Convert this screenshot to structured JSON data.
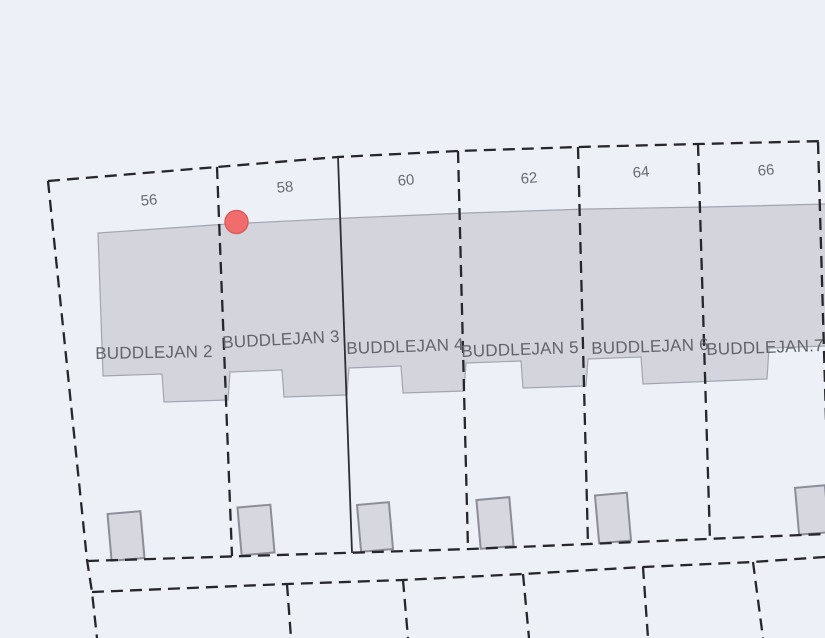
{
  "map": {
    "description": "Cadastral parcel map showing a row of terraced house plots with a highlighted point marker",
    "background_color": "#eef0f8",
    "building": {
      "fill": "#d3d4dc",
      "stroke": "#a3a5b0"
    },
    "shed": {
      "fill": "#d6d7df",
      "stroke": "#8c8d97"
    },
    "boundary_line_color": "#26262b",
    "marker": {
      "fill": "#f16d6d",
      "stroke": "#da5c5c"
    },
    "parcels": [
      {
        "house_number": "56",
        "unit_label": "BUDDLEJAN 2"
      },
      {
        "house_number": "58",
        "unit_label": "BUDDLEJAN 3"
      },
      {
        "house_number": "60",
        "unit_label": "BUDDLEJAN 4"
      },
      {
        "house_number": "62",
        "unit_label": "BUDDLEJAN 5"
      },
      {
        "house_number": "64",
        "unit_label": "BUDDLEJAN 6"
      },
      {
        "house_number": "66",
        "unit_label": "BUDDLEJAN.7"
      }
    ]
  }
}
